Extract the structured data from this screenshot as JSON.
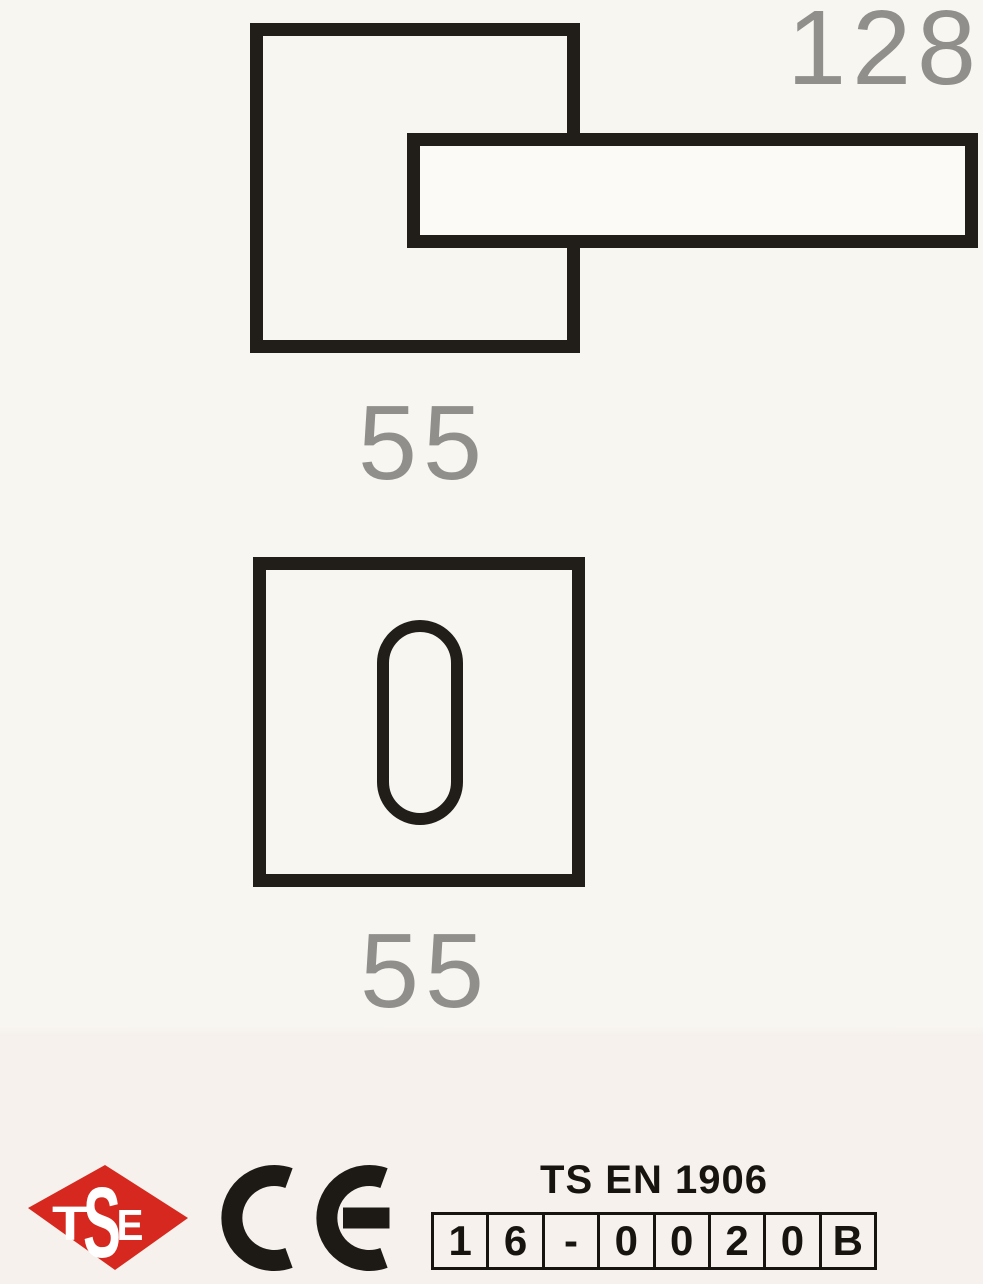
{
  "diagram": {
    "lever_length_label": "128",
    "rose_width_label": "55",
    "escutcheon_width_label": "55"
  },
  "footer": {
    "tse_logo": {
      "letters": [
        "T",
        "S",
        "E"
      ],
      "color": "#d6281e"
    },
    "ce_mark": "CE",
    "standard": {
      "title": "TS EN 1906",
      "code_cells": [
        "1",
        "6",
        "-",
        "0",
        "0",
        "2",
        "0",
        "B"
      ]
    }
  },
  "colors": {
    "background_top": "#f8f6f1",
    "background_bottom": "#f6f1ec",
    "drawing_line": "#211e1a",
    "dimension_text": "#918f8c",
    "certification_text": "#17140f"
  }
}
